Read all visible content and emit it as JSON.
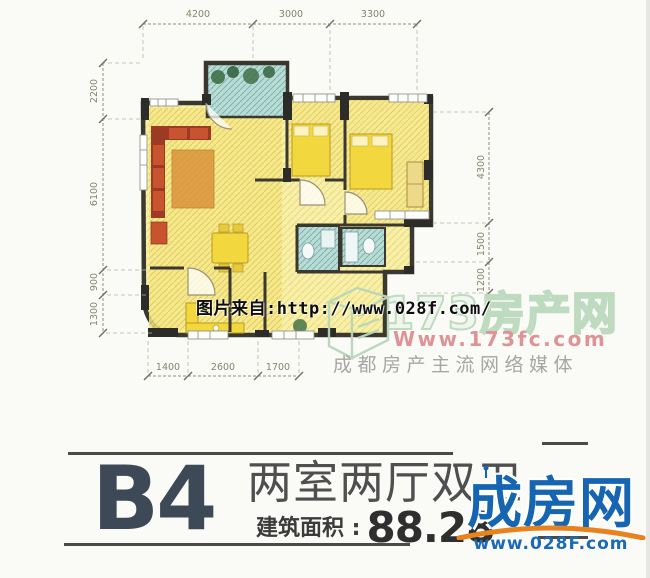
{
  "plan": {
    "dims": {
      "top": [
        "4200",
        "3000",
        "3300"
      ],
      "left": [
        "2200",
        "6100",
        "900",
        "1300"
      ],
      "right": [
        "4300",
        "1500",
        "1200"
      ],
      "bottom": [
        "1400",
        "2600",
        "1700"
      ]
    }
  },
  "watermarks": {
    "image_source": "图片来自:http://www.028f.com/",
    "site_name": "173房产网",
    "site_url": "Www.173fc.com",
    "site_slogan": "成都房产主流网络媒体"
  },
  "title_block": {
    "unit_code": "B4",
    "layout_name": "两室两厅双卫",
    "area_label": "建筑面积 :",
    "area_value": "88.28"
  },
  "corner_logo": {
    "name": "成房网",
    "url": "www.028F.com"
  },
  "colors": {
    "logo_blue": "#1565b2",
    "logo_orange": "#e8821e",
    "wall_dark": "#2e2c28",
    "room_yellow": "#f2d83e",
    "bath_teal": "#b9dcd6",
    "sofa_red": "#9c3a26",
    "title_slate": "#3e4958"
  }
}
